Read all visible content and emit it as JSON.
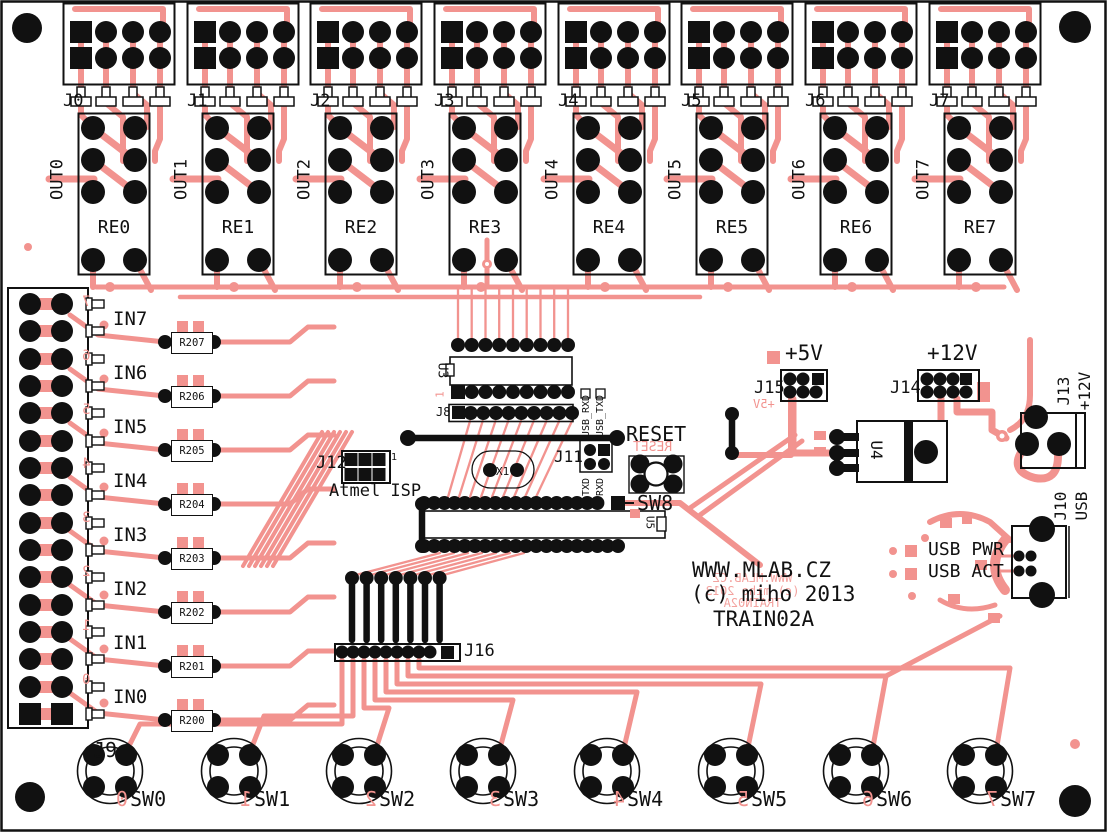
{
  "board": {
    "product": "TRAIN02A",
    "site": "WWW.MLAB.CZ",
    "copyright": "(c) miho 2013",
    "copper_mirror": {
      "site": "WWW.MLAB.CZ",
      "copyright": "(c) miho 2013",
      "product": "TRAIN02A"
    },
    "colors": {
      "copper": "#F2938F",
      "silkscreen": "#111111",
      "substrate": "#FFFFFF",
      "pad": "#000000"
    }
  },
  "top_connectors": [
    {
      "label": "J0"
    },
    {
      "label": "J1"
    },
    {
      "label": "J2"
    },
    {
      "label": "J3"
    },
    {
      "label": "J4"
    },
    {
      "label": "J5"
    },
    {
      "label": "J6"
    },
    {
      "label": "J7"
    }
  ],
  "relays": [
    {
      "label": "RE0",
      "out": "OUT0"
    },
    {
      "label": "RE1",
      "out": "OUT1"
    },
    {
      "label": "RE2",
      "out": "OUT2"
    },
    {
      "label": "RE3",
      "out": "OUT3"
    },
    {
      "label": "RE4",
      "out": "OUT4"
    },
    {
      "label": "RE5",
      "out": "OUT5"
    },
    {
      "label": "RE6",
      "out": "OUT6"
    },
    {
      "label": "RE7",
      "out": "OUT7"
    }
  ],
  "inputs": [
    {
      "label": "IN7",
      "resistor": "R207",
      "copper_digit": "7"
    },
    {
      "label": "IN6",
      "resistor": "R206",
      "copper_digit": "6"
    },
    {
      "label": "IN5",
      "resistor": "R205",
      "copper_digit": "5"
    },
    {
      "label": "IN4",
      "resistor": "R204",
      "copper_digit": "4"
    },
    {
      "label": "IN3",
      "resistor": "R203",
      "copper_digit": "3"
    },
    {
      "label": "IN2",
      "resistor": "R202",
      "copper_digit": "2"
    },
    {
      "label": "IN1",
      "resistor": "R201",
      "copper_digit": "1"
    },
    {
      "label": "IN0",
      "resistor": "R200",
      "copper_digit": "0"
    }
  ],
  "switches": [
    {
      "label": "SW0",
      "copper_digit": "0"
    },
    {
      "label": "SW1",
      "copper_digit": "1"
    },
    {
      "label": "SW2",
      "copper_digit": "2"
    },
    {
      "label": "SW3",
      "copper_digit": "3"
    },
    {
      "label": "SW4",
      "copper_digit": "4"
    },
    {
      "label": "SW5",
      "copper_digit": "5"
    },
    {
      "label": "SW6",
      "copper_digit": "6"
    },
    {
      "label": "SW7",
      "copper_digit": "7"
    }
  ],
  "left_connector": {
    "label": "J9"
  },
  "mcu": {
    "u3": "U3",
    "u3_pin1": "1",
    "u5": "U5",
    "j8": "J8"
  },
  "serial": {
    "j11": "J11",
    "usb_rxd": "USB_RXD",
    "usb_txd": "USB_TXD",
    "txd": "TXD",
    "rxd": "RXD"
  },
  "isp": {
    "j12": "J12",
    "name": "Atmel ISP",
    "pin1": "1"
  },
  "reset": {
    "label": "RESET",
    "copper_mirror": "RESET",
    "sw": "SW8"
  },
  "xtal": {
    "label": "X1"
  },
  "power": {
    "j15": "J15",
    "v5": "+5V",
    "v5_mirror": "+5V",
    "j14": "J14",
    "v12": "+12V",
    "u4": "U4",
    "j13": "J13",
    "j13_v12": "+12V"
  },
  "usb": {
    "j10": "J10",
    "label": "USB",
    "pwr": "USB PWR",
    "act": "USB ACT"
  },
  "aux": {
    "j16": "J16"
  }
}
